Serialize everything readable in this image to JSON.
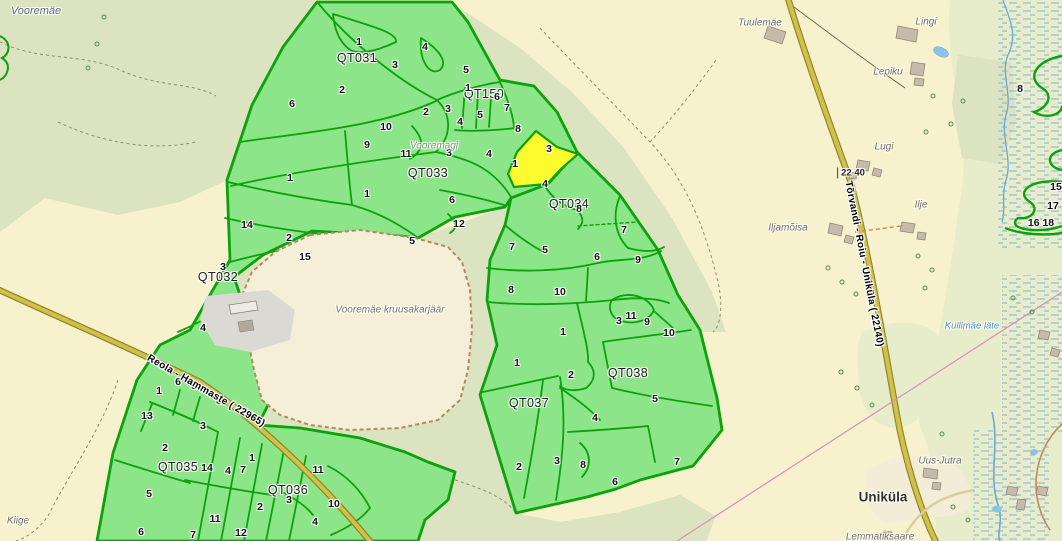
{
  "map": {
    "colors": {
      "base": "#f7f1cd",
      "forest1": "#dce3c0",
      "forest2": "#e7edca",
      "comp-fill": "#8de589",
      "comp-stroke": "#0ba20b",
      "highlight": "#fbfb2d",
      "road-fill": "#cfc14a",
      "road-casing": "#8f8626",
      "water": "#69a8d8",
      "marsh": "#7fb2d8",
      "quarry-fill": "#f6efd8",
      "quarry-edge": "#b08a62",
      "powerline": "#dc93b8"
    },
    "compartment_labels": [
      {
        "id": "QT031",
        "x": 357,
        "y": 58
      },
      {
        "id": "QT150",
        "x": 484,
        "y": 94
      },
      {
        "id": "QT033",
        "x": 428,
        "y": 173
      },
      {
        "id": "QT032",
        "x": 218,
        "y": 277
      },
      {
        "id": "QT034",
        "x": 569,
        "y": 204
      },
      {
        "id": "QT035",
        "x": 178,
        "y": 467
      },
      {
        "id": "QT036",
        "x": 288,
        "y": 490
      },
      {
        "id": "QT037",
        "x": 529,
        "y": 403
      },
      {
        "id": "QT038",
        "x": 628,
        "y": 373
      }
    ],
    "stand_numbers": [
      {
        "n": "1",
        "x": 359,
        "y": 42
      },
      {
        "n": "4",
        "x": 425,
        "y": 47
      },
      {
        "n": "3",
        "x": 395,
        "y": 65
      },
      {
        "n": "5",
        "x": 466,
        "y": 70
      },
      {
        "n": "2",
        "x": 342,
        "y": 90
      },
      {
        "n": "6",
        "x": 292,
        "y": 104
      },
      {
        "n": "1",
        "x": 468,
        "y": 88
      },
      {
        "n": "6",
        "x": 497,
        "y": 97
      },
      {
        "n": "7",
        "x": 507,
        "y": 108
      },
      {
        "n": "3",
        "x": 448,
        "y": 109
      },
      {
        "n": "2",
        "x": 426,
        "y": 112
      },
      {
        "n": "5",
        "x": 480,
        "y": 115
      },
      {
        "n": "4",
        "x": 460,
        "y": 122
      },
      {
        "n": "8",
        "x": 518,
        "y": 129
      },
      {
        "n": "10",
        "x": 386,
        "y": 127
      },
      {
        "n": "9",
        "x": 367,
        "y": 145
      },
      {
        "n": "11",
        "x": 406,
        "y": 154
      },
      {
        "n": "3",
        "x": 449,
        "y": 153
      },
      {
        "n": "4",
        "x": 489,
        "y": 154
      },
      {
        "n": "1",
        "x": 515,
        "y": 164
      },
      {
        "n": "3",
        "x": 549,
        "y": 149
      },
      {
        "n": "4",
        "x": 545,
        "y": 184
      },
      {
        "n": "1",
        "x": 290,
        "y": 178
      },
      {
        "n": "1",
        "x": 367,
        "y": 194
      },
      {
        "n": "6",
        "x": 452,
        "y": 200
      },
      {
        "n": "12",
        "x": 459,
        "y": 224
      },
      {
        "n": "5",
        "x": 412,
        "y": 241
      },
      {
        "n": "14",
        "x": 247,
        "y": 225
      },
      {
        "n": "2",
        "x": 289,
        "y": 238
      },
      {
        "n": "15",
        "x": 305,
        "y": 257
      },
      {
        "n": "3",
        "x": 223,
        "y": 267
      },
      {
        "n": "4",
        "x": 203,
        "y": 328
      },
      {
        "n": "8",
        "x": 579,
        "y": 209
      },
      {
        "n": "7",
        "x": 624,
        "y": 230
      },
      {
        "n": "7",
        "x": 512,
        "y": 247
      },
      {
        "n": "5",
        "x": 545,
        "y": 250
      },
      {
        "n": "6",
        "x": 597,
        "y": 257
      },
      {
        "n": "9",
        "x": 638,
        "y": 260
      },
      {
        "n": "8",
        "x": 511,
        "y": 290
      },
      {
        "n": "10",
        "x": 560,
        "y": 292
      },
      {
        "n": "1",
        "x": 563,
        "y": 332
      },
      {
        "n": "11",
        "x": 631,
        "y": 316
      },
      {
        "n": "3",
        "x": 619,
        "y": 321
      },
      {
        "n": "9",
        "x": 647,
        "y": 322
      },
      {
        "n": "10",
        "x": 669,
        "y": 333
      },
      {
        "n": "1",
        "x": 517,
        "y": 363
      },
      {
        "n": "2",
        "x": 571,
        "y": 375
      },
      {
        "n": "5",
        "x": 655,
        "y": 399
      },
      {
        "n": "4",
        "x": 595,
        "y": 418
      },
      {
        "n": "3",
        "x": 557,
        "y": 461
      },
      {
        "n": "2",
        "x": 519,
        "y": 467
      },
      {
        "n": "8",
        "x": 583,
        "y": 465
      },
      {
        "n": "7",
        "x": 677,
        "y": 462
      },
      {
        "n": "6",
        "x": 615,
        "y": 482
      },
      {
        "n": "6",
        "x": 178,
        "y": 382
      },
      {
        "n": "5",
        "x": 194,
        "y": 386
      },
      {
        "n": "1",
        "x": 159,
        "y": 391
      },
      {
        "n": "8",
        "x": 219,
        "y": 401
      },
      {
        "n": "13",
        "x": 147,
        "y": 416
      },
      {
        "n": "3",
        "x": 203,
        "y": 426
      },
      {
        "n": "2",
        "x": 165,
        "y": 448
      },
      {
        "n": "1",
        "x": 252,
        "y": 458
      },
      {
        "n": "14",
        "x": 207,
        "y": 468
      },
      {
        "n": "4",
        "x": 228,
        "y": 471
      },
      {
        "n": "7",
        "x": 243,
        "y": 470
      },
      {
        "n": "11",
        "x": 318,
        "y": 470
      },
      {
        "n": "5",
        "x": 149,
        "y": 494
      },
      {
        "n": "3",
        "x": 289,
        "y": 500
      },
      {
        "n": "10",
        "x": 334,
        "y": 504
      },
      {
        "n": "2",
        "x": 260,
        "y": 507
      },
      {
        "n": "11",
        "x": 215,
        "y": 519
      },
      {
        "n": "4",
        "x": 315,
        "y": 522
      },
      {
        "n": "6",
        "x": 141,
        "y": 532
      },
      {
        "n": "12",
        "x": 241,
        "y": 533
      },
      {
        "n": "7",
        "x": 193,
        "y": 535
      }
    ],
    "edge_numbers": [
      {
        "n": "8",
        "x": 1020,
        "y": 89
      },
      {
        "n": "15",
        "x": 1056,
        "y": 187
      },
      {
        "n": "17",
        "x": 1053,
        "y": 206
      },
      {
        "n": "16 18",
        "x": 1041,
        "y": 223
      }
    ],
    "place_names": [
      {
        "text": "Vooremäe",
        "x": 36,
        "y": 11,
        "cls": "hillname"
      },
      {
        "text": "Tuulemäe",
        "x": 760,
        "y": 23,
        "cls": ""
      },
      {
        "text": "Lingi",
        "x": 926,
        "y": 22,
        "cls": ""
      },
      {
        "text": "Lepiku",
        "x": 888,
        "y": 72,
        "cls": ""
      },
      {
        "text": "Lugi",
        "x": 884,
        "y": 147,
        "cls": ""
      },
      {
        "text": "Ilje",
        "x": 921,
        "y": 205,
        "cls": ""
      },
      {
        "text": "Iljamõisa",
        "x": 788,
        "y": 228,
        "cls": ""
      },
      {
        "text": "Vooremägi",
        "x": 434,
        "y": 146,
        "cls": "hill-green"
      },
      {
        "text": "Vooremäe kruusakarjäär",
        "x": 390,
        "y": 310,
        "cls": "quarryname"
      },
      {
        "text": "Kullimäe läte",
        "x": 972,
        "y": 326,
        "cls": "water-name"
      },
      {
        "text": "Uus-Jutra",
        "x": 940,
        "y": 461,
        "cls": ""
      },
      {
        "text": "Uniküla",
        "x": 883,
        "y": 497,
        "cls": "village"
      },
      {
        "text": "Lemmatiksaare",
        "x": 880,
        "y": 537,
        "cls": ""
      },
      {
        "text": "Kiige",
        "x": 18,
        "y": 521,
        "cls": ""
      }
    ],
    "road_labels": [
      {
        "text": "Reola - Hammaste ( 22965)",
        "x": 206,
        "y": 391,
        "rot": 30
      },
      {
        "text": "Tõrvandi - Roiu - Uniküla ( 22140)",
        "x": 864,
        "y": 264,
        "rot": 79
      }
    ],
    "km_marker": {
      "text": "22 40",
      "x": 851,
      "y": 173
    }
  }
}
